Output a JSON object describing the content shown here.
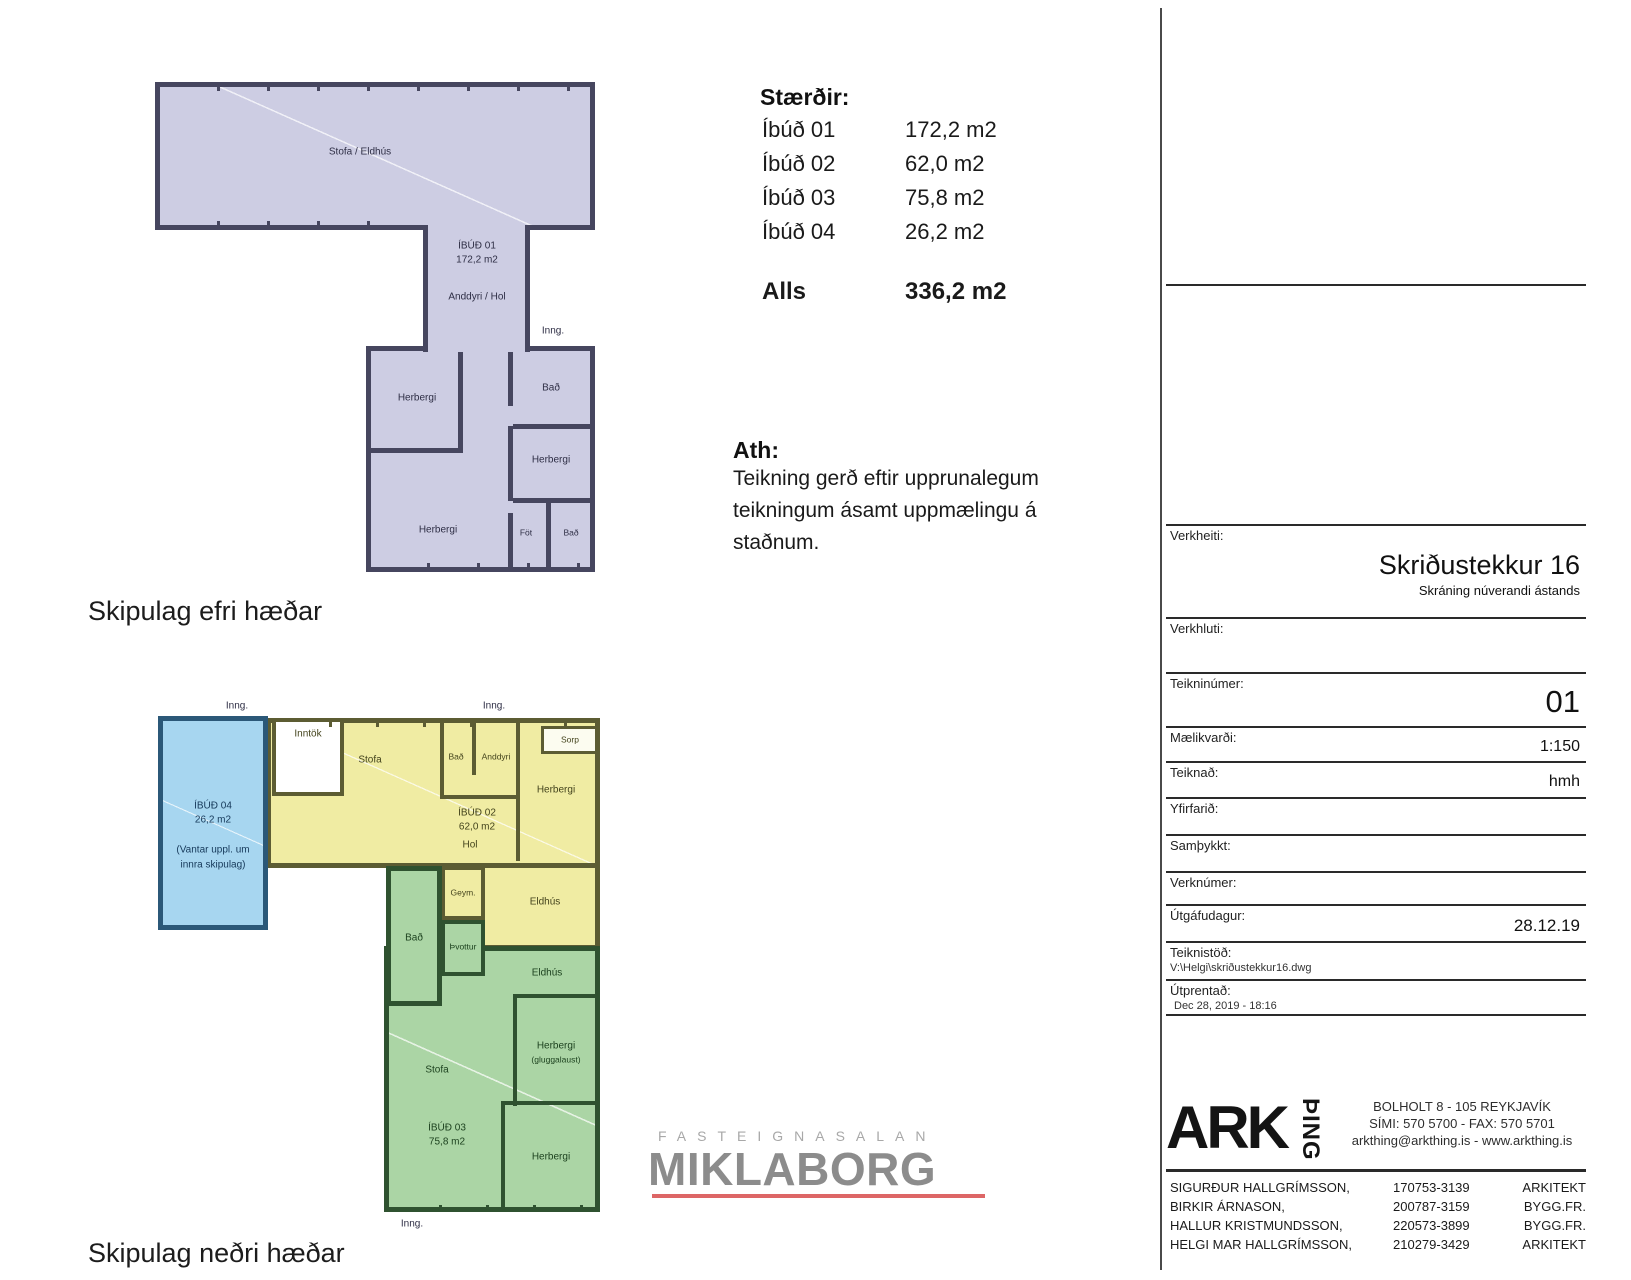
{
  "titles": {
    "upper": "Skipulag efri hæðar",
    "lower": "Skipulag neðri hæðar"
  },
  "sizes_table": {
    "heading": "Stærðir:",
    "rows": [
      {
        "label": "Íbúð 01",
        "value": "172,2 m2"
      },
      {
        "label": "Íbúð 02",
        "value": "62,0 m2"
      },
      {
        "label": "Íbúð 03",
        "value": "75,8 m2"
      },
      {
        "label": "Íbúð 04",
        "value": "26,2 m2"
      }
    ],
    "total_label": "Alls",
    "total_value": "336,2 m2"
  },
  "note": {
    "heading": "Ath:",
    "lines": [
      "Teikning gerð eftir upprunalegum",
      "teikningum ásamt uppmælingu á",
      "staðnum."
    ]
  },
  "upper_plan": {
    "inng": "Inng.",
    "unit": "ÍBÚÐ 01",
    "area": "172,2 m2",
    "rooms": {
      "stofa_eldhus": "Stofa / Eldhús",
      "anddyri_hol": "Anddyri / Hol",
      "herbergi1": "Herbergi",
      "bad1": "Bað",
      "herbergi2": "Herbergi",
      "herbergi3": "Herbergi",
      "fot": "Föt",
      "bad2": "Bað"
    }
  },
  "lower_plan": {
    "inng": "Inng.",
    "ibud04": {
      "label": "ÍBÚÐ 04",
      "area": "26,2 m2",
      "note1": "(Vantar uppl. um",
      "note2": "innra skipulag)"
    },
    "ibud02": {
      "label": "ÍBÚÐ 02",
      "area": "62,0 m2"
    },
    "ibud03": {
      "label": "ÍBÚÐ 03",
      "area": "75,8 m2"
    },
    "rooms": {
      "inntok": "Inntök",
      "sorp": "Sorp",
      "stofa_yellow": "Stofa",
      "bad_yellow": "Bað",
      "anddyri": "Anddyri",
      "herbergi_yellow": "Herbergi",
      "hol": "Hol",
      "geym": "Geym.",
      "eldhus_yellow": "Eldhús",
      "bad_green": "Bað",
      "thvottur": "Þvottur",
      "eldhus_green": "Eldhús",
      "stofa_green": "Stofa",
      "herbergi_g1": "Herbergi",
      "herbergi_g1b": "(gluggalaust)",
      "herbergi_g2": "Herbergi"
    }
  },
  "miklaborg": {
    "tagline": "FASTEIGNASALAN",
    "name": "MIKLABORG"
  },
  "title_block": {
    "verkheiti_label": "Verkheiti:",
    "project_name": "Skriðustekkur 16",
    "project_subtitle": "Skráning núverandi ástands",
    "verkhluti_label": "Verkhluti:",
    "teikninumer_label": "Teikninúmer:",
    "drawing_number": "01",
    "maelikvardi_label": "Mælikvarði:",
    "scale": "1:150",
    "teiknad_label": "Teiknað:",
    "drawn_by": "hmh",
    "yfirfarid_label": "Yfirfarið:",
    "samthykkt_label": "Samþykkt:",
    "verknumer_label": "Verknúmer:",
    "utgafudagur_label": "Útgáfudagur:",
    "issue_date": "28.12.19",
    "teiknistod_label": "Teiknistöð:",
    "file_path": "V:\\Helgi\\skriðustekkur16.dwg",
    "utprentad_label": "Útprentað:",
    "printed": "Dec 28, 2019 - 18:16"
  },
  "arkthing": {
    "logo_main": "ARK",
    "logo_sub": "ÞING",
    "address_lines": [
      "BOLHOLT 8 - 105 REYKJAVÍK",
      "SÍMI: 570 5700 - FAX: 570 5701",
      "arkthing@arkthing.is - www.arkthing.is"
    ]
  },
  "staff": [
    {
      "name": "SIGURÐUR HALLGRÍMSSON,",
      "id": "170753-3139",
      "role": "ARKITEKT"
    },
    {
      "name": "BIRKIR ÁRNASON,",
      "id": "200787-3159",
      "role": "BYGG.FR."
    },
    {
      "name": "HALLUR KRISTMUNDSSON,",
      "id": "220573-3899",
      "role": "BYGG.FR."
    },
    {
      "name": "HELGI MAR HALLGRÍMSSON,",
      "id": "210279-3429",
      "role": "ARKITEKT"
    }
  ],
  "colors": {
    "wall-upper": "#46465f",
    "fill-upper": "#cdcde3",
    "wall-yellow": "#5c5c33",
    "fill-yellow": "#f0eca3",
    "wall-green": "#2f5230",
    "fill-green": "#abd5a5",
    "wall-blue": "#2b5878",
    "fill-blue": "#a7d6f0",
    "accent-red": "#dd6666",
    "logo-gray": "#8c8c8c"
  }
}
